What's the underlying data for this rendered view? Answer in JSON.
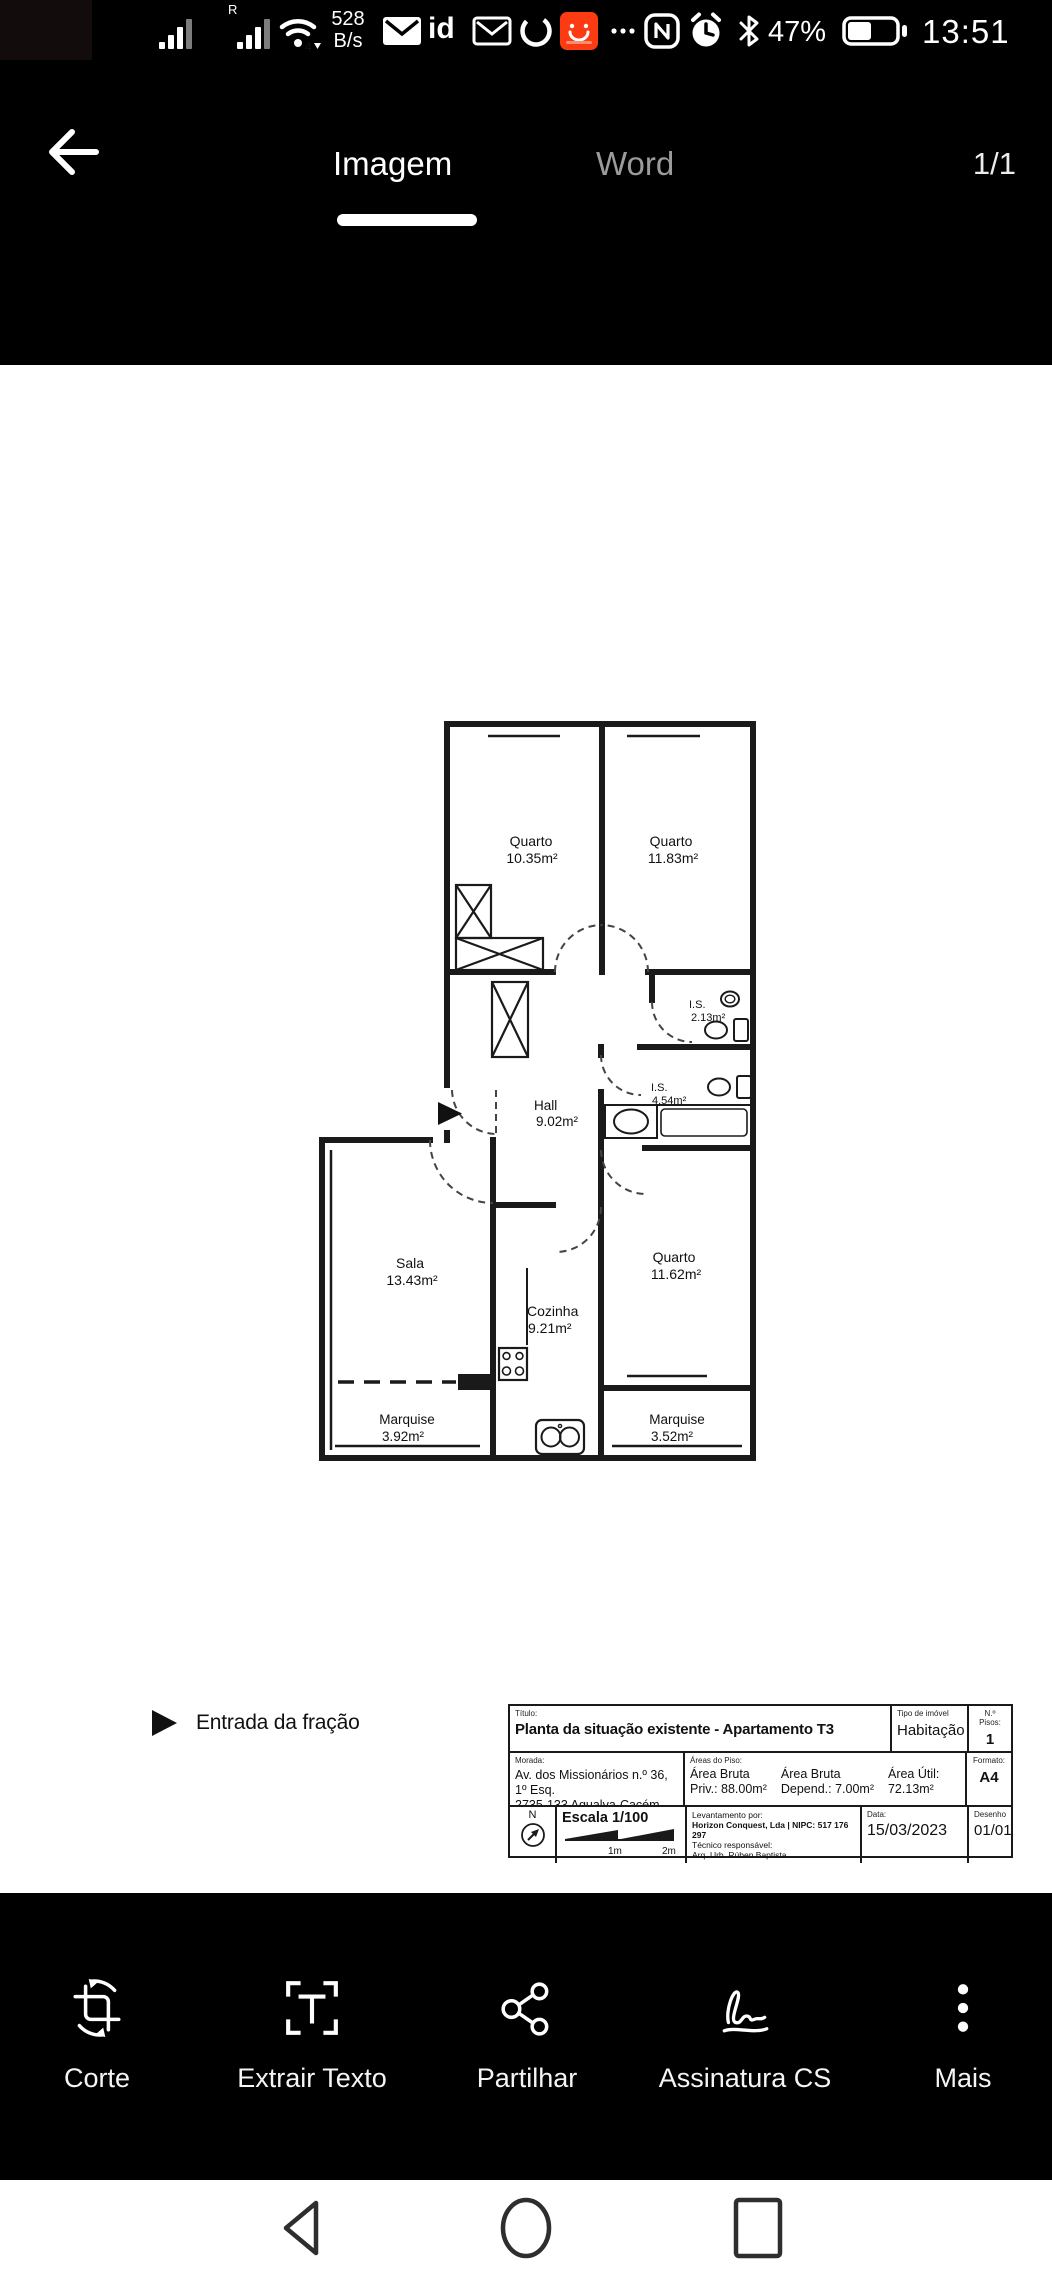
{
  "status_bar": {
    "r_indicator": "R",
    "speed_value": "528",
    "speed_unit": "B/s",
    "id_label": "id",
    "wifi_badge": "4",
    "battery_percent": "47%",
    "time": "13:51"
  },
  "header": {
    "tab_image": "Imagem",
    "tab_word": "Word",
    "page_indicator": "1/1"
  },
  "plan": {
    "entrance_label": "Entrada da fração",
    "rooms": [
      {
        "name": "Quarto",
        "area": "10.35m²"
      },
      {
        "name": "Quarto",
        "area": "11.83m²"
      },
      {
        "name": "I.S.",
        "area": "2.13m²"
      },
      {
        "name": "I.S.",
        "area": "4.54m²"
      },
      {
        "name": "Hall",
        "area": "9.02m²"
      },
      {
        "name": "Sala",
        "area": "13.43m²"
      },
      {
        "name": "Cozinha",
        "area": "9.21m²"
      },
      {
        "name": "Quarto",
        "area": "11.62m²"
      },
      {
        "name": "Marquise",
        "area": "3.92m²"
      },
      {
        "name": "Marquise",
        "area": "3.52m²"
      }
    ]
  },
  "title_block": {
    "titulo_label": "Título:",
    "titulo": "Planta da situação existente - Apartamento T3",
    "tipo_label": "Tipo de imóvel",
    "tipo": "Habitação",
    "pisos_label": "N.º Pisos:",
    "pisos": "1",
    "morada_label": "Morada:",
    "morada_line1": "Av. dos Missionários n.º 36, 1º Esq.",
    "morada_line2": "2735-133 Agualva-Cacém, Sintra",
    "areas_label": "Áreas do Piso:",
    "area1_l1": "Área Bruta",
    "area1_l2": "Priv.: 88.00m²",
    "area2_l1": "Área Bruta",
    "area2_l2": "Depend.: 7.00m²",
    "area3_l1": "Área Útil:",
    "area3_l2": "72.13m²",
    "formato_label": "Formato:",
    "formato": "A4",
    "north": "N",
    "escala": "Escala 1/100",
    "scale_1m": "1m",
    "scale_2m": "2m",
    "levantamento_label": "Levantamento por:",
    "levantamento": "Horizon Conquest, Lda | NIPC: 517 176 297",
    "tecnico_label": "Técnico responsável:",
    "tecnico": "Arq. Urb. Rúben Baptista",
    "data_label": "Data:",
    "data": "15/03/2023",
    "desenho_label": "Desenho",
    "desenho": "01/01"
  },
  "toolbar": {
    "items": [
      {
        "label": "Corte"
      },
      {
        "label": "Extrair Texto"
      },
      {
        "label": "Partilhar"
      },
      {
        "label": "Assinatura CS"
      },
      {
        "label": "Mais"
      }
    ]
  }
}
